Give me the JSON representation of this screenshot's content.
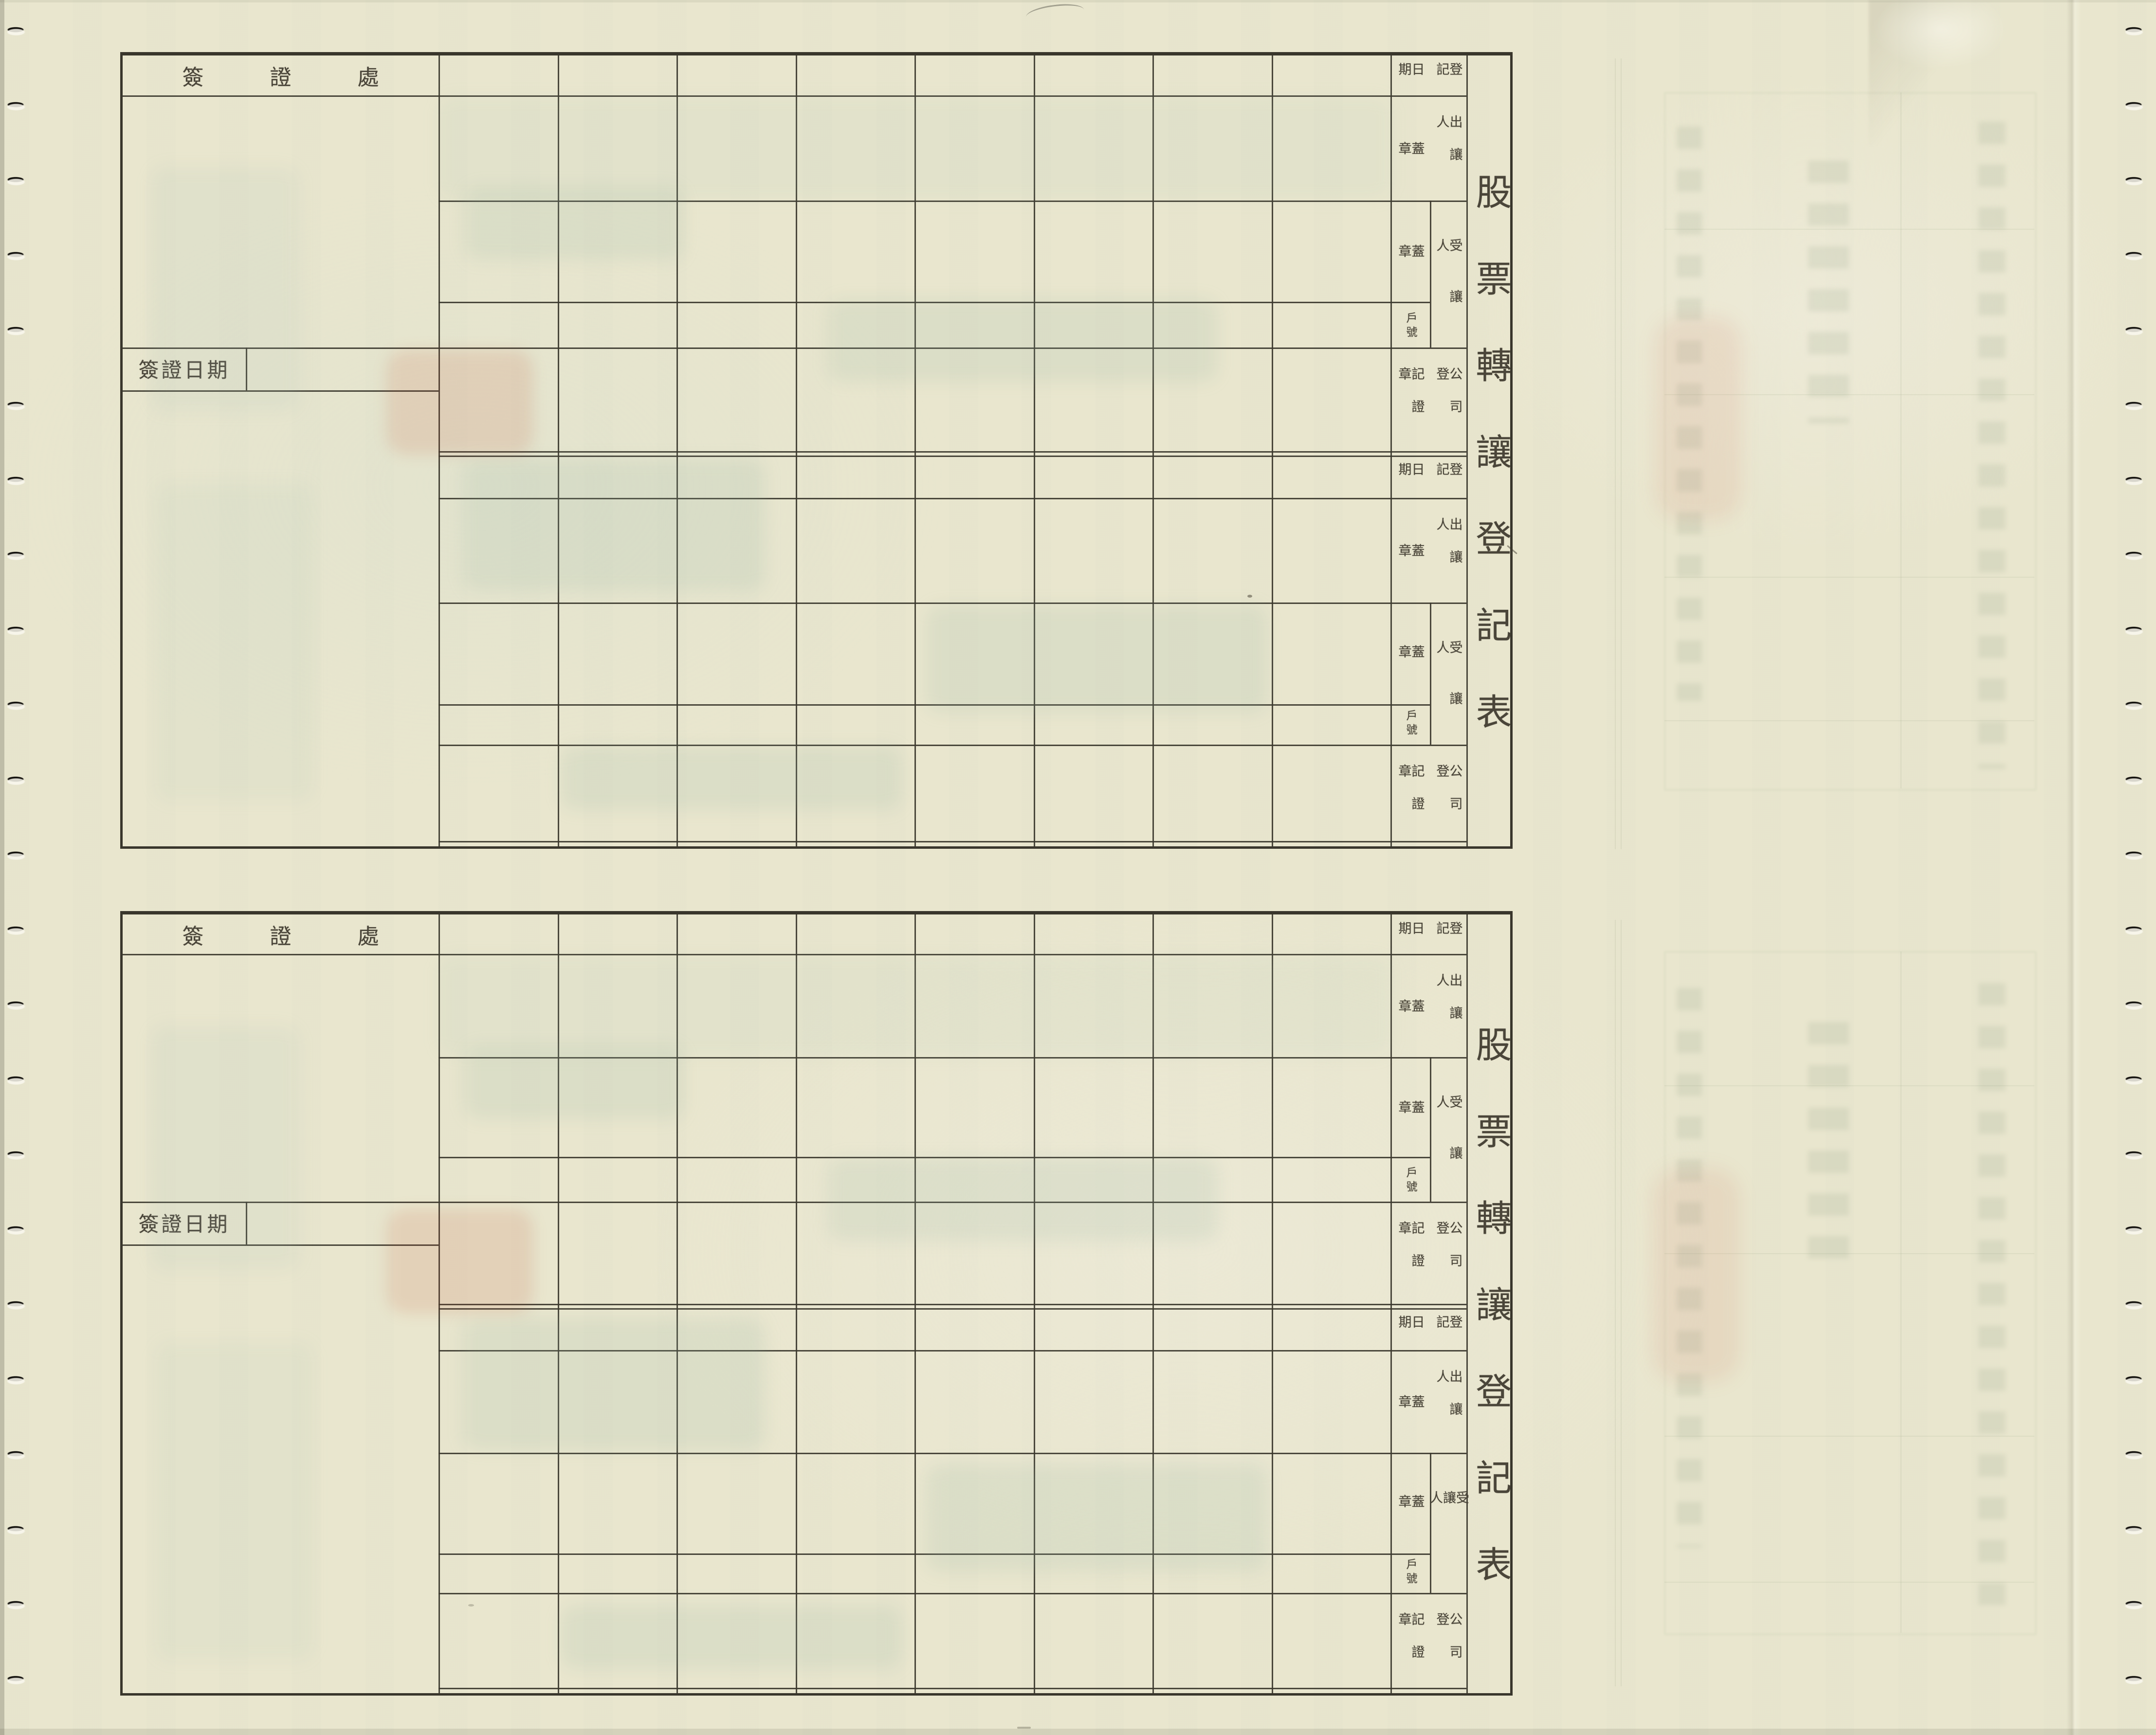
{
  "form": {
    "title": "股票轉讓登記表",
    "certification_office_label": "簽證處",
    "certification_date_label": "簽證日期",
    "field_labels": {
      "registration": "登記",
      "date": "日期",
      "transferor": "出讓人",
      "seal": "蓋章",
      "transferee": "受讓人",
      "account_number": "戶號",
      "company_registration": "公司登",
      "certificate_seal": "記證章"
    },
    "colors": {
      "paper": "#e9e6ce",
      "grid_line": "#3c392f",
      "ink_text": "#4a4539",
      "punch_hole": "#14120e"
    }
  }
}
